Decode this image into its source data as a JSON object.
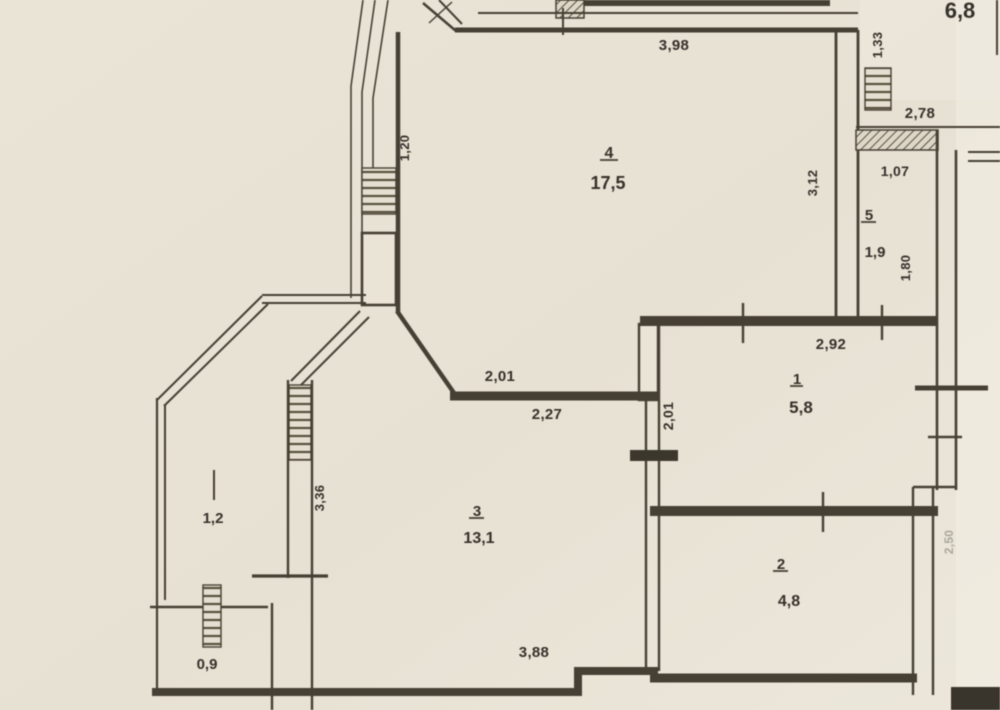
{
  "floor_plan": {
    "rooms": [
      {
        "number": "4",
        "area": "17,5"
      },
      {
        "number": "5",
        "area": "1,9"
      },
      {
        "number": "1",
        "area": "5,8"
      },
      {
        "number": "3",
        "area": "13,1"
      },
      {
        "number": "2",
        "area": "4,8"
      }
    ],
    "balconies": {
      "left_area": "1,2",
      "bottom_area": "0,9",
      "top_right_area": "6,8"
    },
    "dimensions": {
      "top_width": "3,98",
      "top_right_vertical": "1,33",
      "loggia_width": "2,78",
      "niche_width": "1,07",
      "room4_right_height": "3,12",
      "room5_right_height": "1,80",
      "room1_top_width": "2,92",
      "hall_top_width": "2,01",
      "hall_bottom_width": "2,27",
      "divider_height": "2,01",
      "room3_left_height": "3,36",
      "balcony_left_window": "1,20",
      "bottom_width": "3,88",
      "right_lower_height": "2,50"
    },
    "colors": {
      "paper": "#e9e3d6",
      "ink": "#464034",
      "text": "#35302a"
    }
  }
}
